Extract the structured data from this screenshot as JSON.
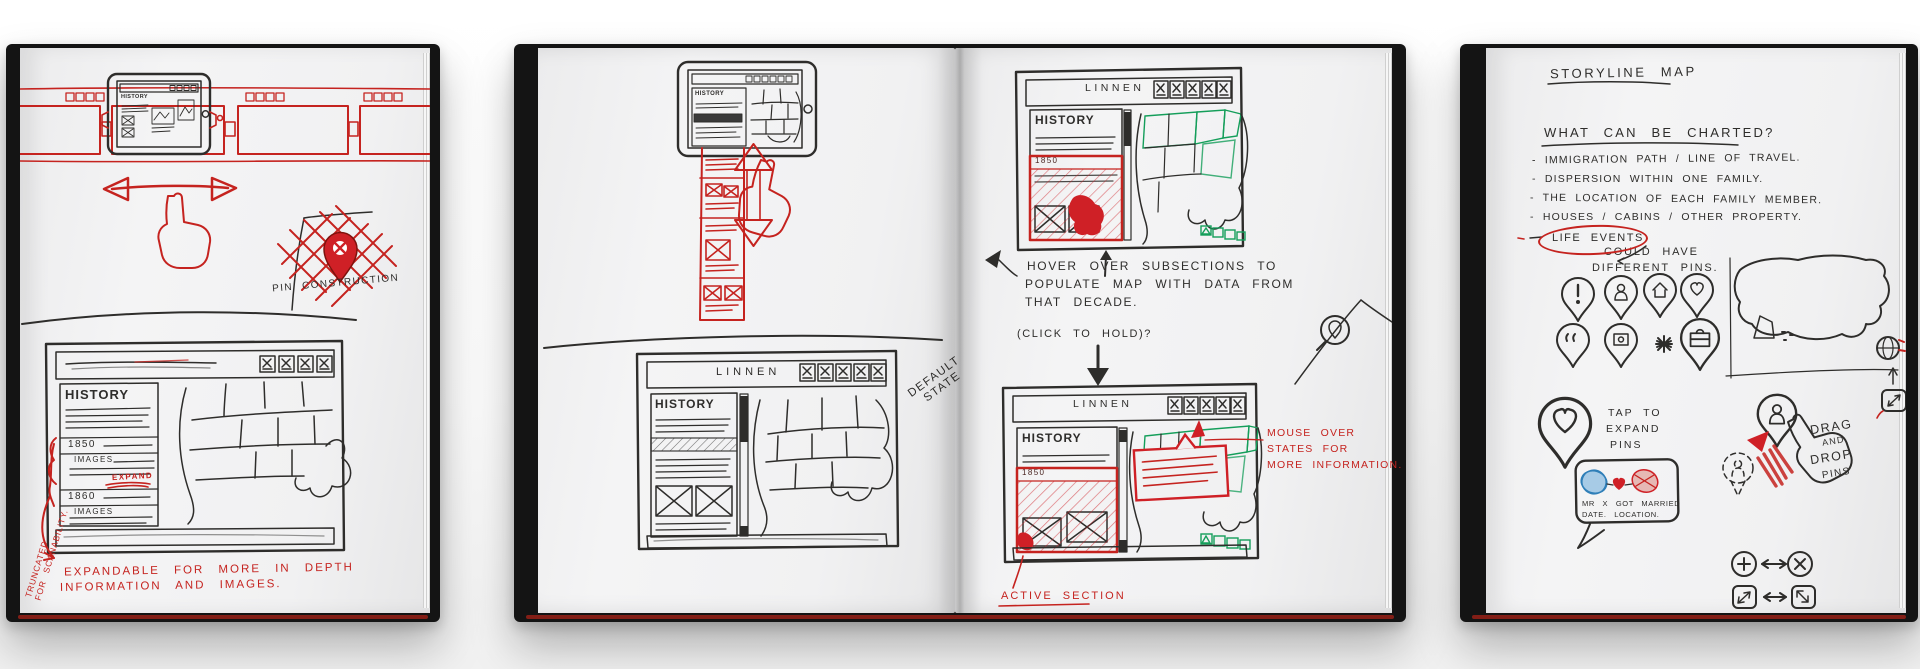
{
  "colors": {
    "ink": "#2e2d2b",
    "red": "#c5231f",
    "green": "#149e5a",
    "blue": "#3f8fc4",
    "page": "#f1f1f2",
    "cover": "#141414"
  },
  "b1": {
    "tablet_title": "HISTORY",
    "pin_label": "PIN CONSTRUCTION",
    "wf_title": "HISTORY",
    "year1": "1850",
    "images1": "IMAGES",
    "expand": "EXPAND",
    "year2": "1860",
    "images2": "IMAGES",
    "side_note1": "TRUNCATED",
    "side_note2": "FOR SCANABILITY.",
    "caption1": "EXPANDABLE FOR MORE IN DEPTH",
    "caption2": "INFORMATION AND IMAGES."
  },
  "b2": {
    "tablet_title": "HISTORY",
    "wf_title": "LINNEN",
    "wf_sidebar": "HISTORY",
    "state1": "DEFAULT",
    "state2": "STATE"
  },
  "b3": {
    "top_title": "LINNEN",
    "top_sidebar": "HISTORY",
    "top_year": "1850",
    "n1": "HOVER OVER SUBSECTIONS TO",
    "n2": "POPULATE MAP WITH DATA FROM",
    "n3": "THAT DECADE.",
    "n4": "(CLICK TO HOLD)?",
    "bot_title": "LINNEN",
    "bot_sidebar": "HISTORY",
    "bot_year": "1850",
    "m1": "MOUSE OVER",
    "m2": "STATES FOR",
    "m3": "MORE INFORMATION.",
    "active": "ACTIVE SECTION"
  },
  "b4": {
    "title": "STORYLINE MAP",
    "question": "WHAT CAN BE CHARTED?",
    "bullets": [
      "- IMMIGRATION PATH / LINE OF TRAVEL.",
      "- DISPERSION WITHIN ONE FAMILY.",
      "- THE LOCATION OF EACH FAMILY MEMBER.",
      "- HOUSES / CABINS / OTHER PROPERTY.",
      "LIFE EVENTS"
    ],
    "could1": "COULD HAVE",
    "could2": "DIFFERENT PINS.",
    "tap1": "TAP TO",
    "tap2": "EXPAND",
    "tap3": "PINS",
    "bub1": "MR X GOT MARRIED",
    "bub2": "DATE. LOCATION.",
    "drag1": "DRAG",
    "drag2": "AND",
    "drag3": "DROP",
    "drag4": "PINS"
  }
}
